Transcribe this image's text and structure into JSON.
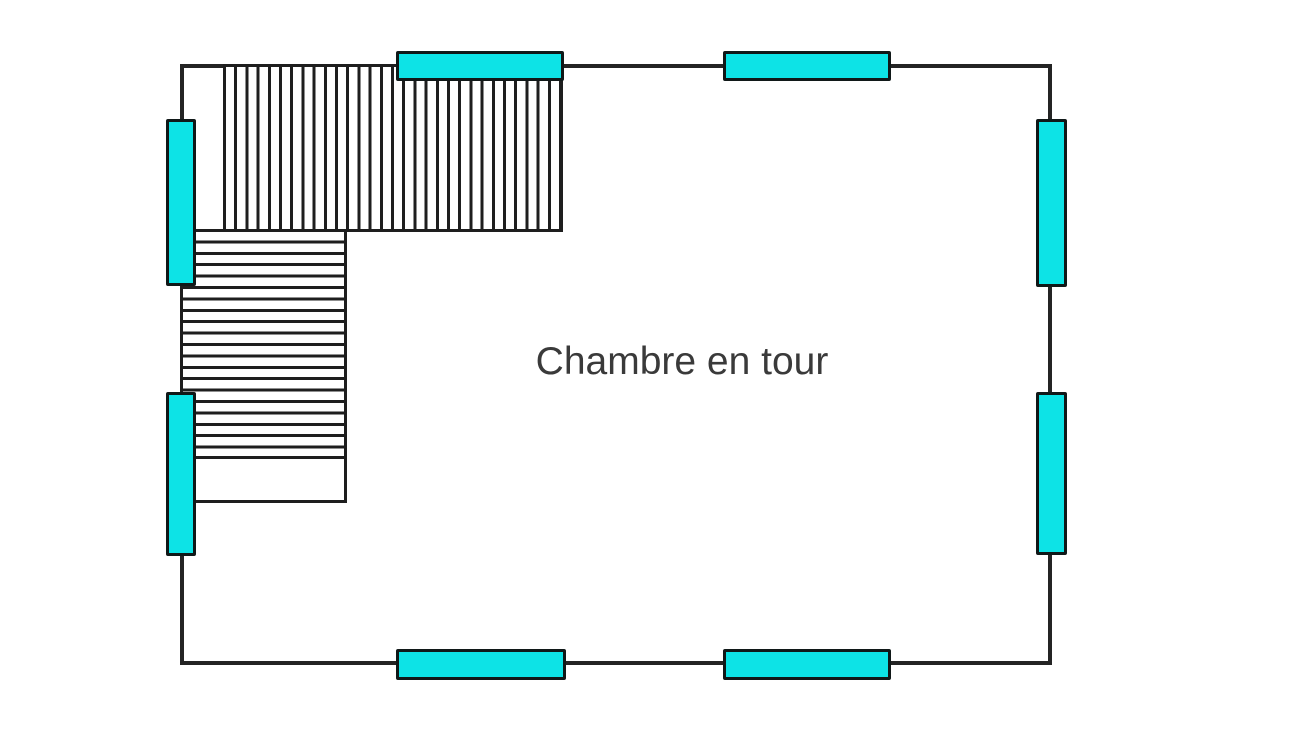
{
  "floor_plan": {
    "room_label": "Chambre en tour",
    "colors": {
      "wall": "#242424",
      "hatch_line": "#1e1e1e",
      "window_fill": "#0de3e6",
      "window_border": "#101818",
      "label_text": "#3a3a3a",
      "background": "#ffffff"
    },
    "stairs": {
      "upper_flight": {
        "hatch_direction": "vertical",
        "position": "top-left of room"
      },
      "lower_flight": {
        "hatch_direction": "horizontal",
        "position": "left side below upper flight",
        "landing": "blank area at bottom of flight"
      }
    },
    "windows": [
      {
        "id": "top-left",
        "wall": "top"
      },
      {
        "id": "top-right",
        "wall": "top"
      },
      {
        "id": "left-upper",
        "wall": "left"
      },
      {
        "id": "left-lower",
        "wall": "left"
      },
      {
        "id": "right-upper",
        "wall": "right"
      },
      {
        "id": "right-lower",
        "wall": "right"
      },
      {
        "id": "bottom-left",
        "wall": "bottom"
      },
      {
        "id": "bottom-right",
        "wall": "bottom"
      }
    ]
  }
}
